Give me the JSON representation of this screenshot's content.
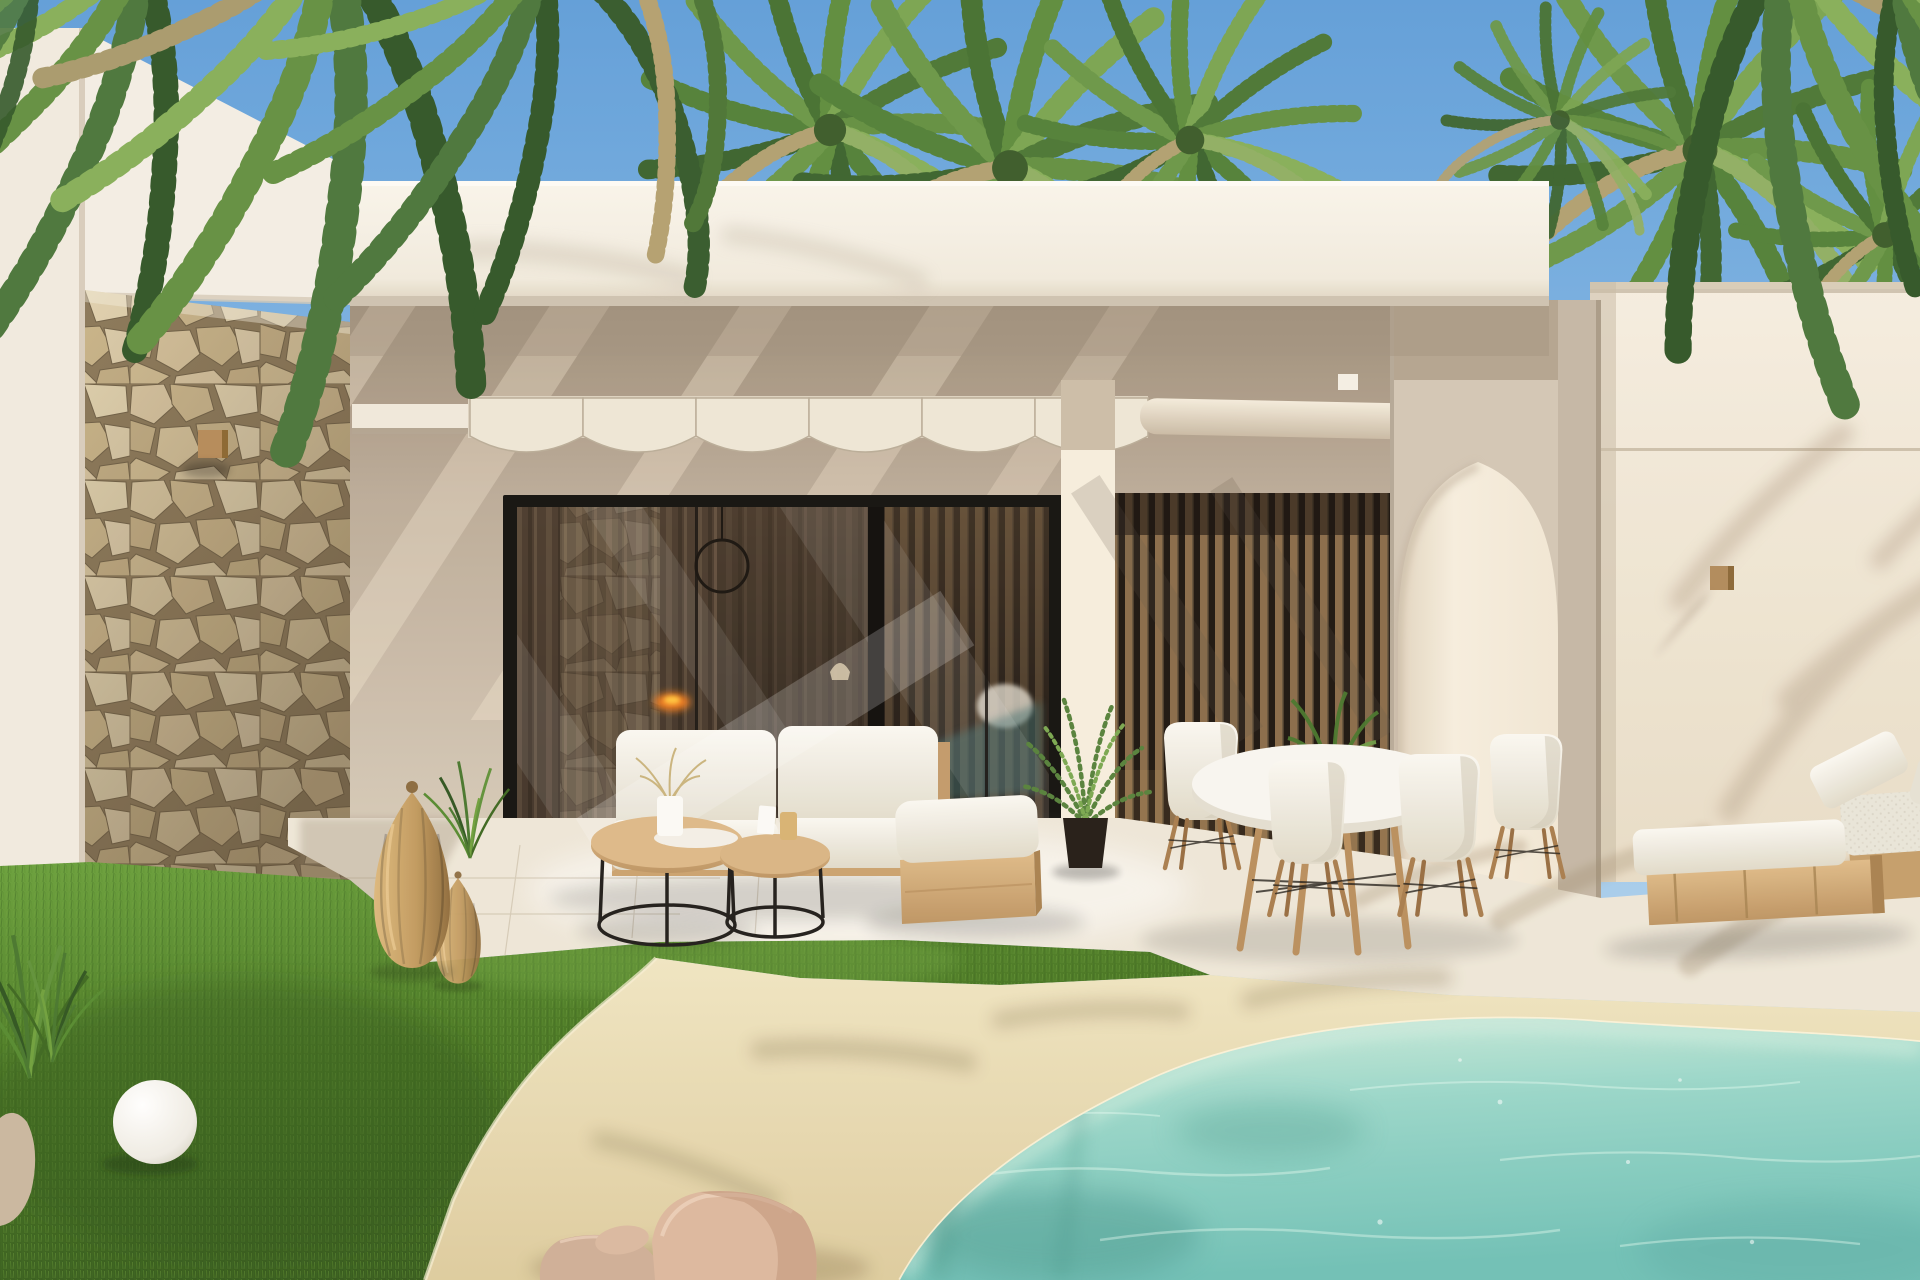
{
  "scene": {
    "title": "Modern Mediterranean villa with private pool",
    "description": "Photorealistic daytime exterior render of a cream-white modern villa: natural stone accent wall on the left, covered patio with pergola and scalloped shade canopy, black-framed sliding glass doors reflecting the interior, vertical wood slat screen, pointed arch wall opening, detached right wing wall with wooden sconce, palm trees overhead, outdoor lounge set with nesting coffee tables, round white dining set with four shell chairs, two wooden sun loungers, rattan lanterns, a white sphere lamp, green lawn, sandy free-form pool deck with pink boulders and a turquoise pool.",
    "time_of_day": "sunny daytime",
    "weather": "clear blue sky",
    "palette": {
      "sky_top": "#6fa9de",
      "sky_horizon": "#c4def1",
      "wall_cream": "#f4efe4",
      "wall_shadow": "#a2927e",
      "stone_beige": "#d5c29b",
      "stone_mortar": "#8a7758",
      "wood_warm": "#a97e52",
      "wood_light": "#d4ac76",
      "glass_dark": "#2a211a",
      "slat_brown": "#9c7a52",
      "cushion_white": "#f2efe8",
      "grass_green": "#4c7c2b",
      "sand_beige": "#e9dcb2",
      "pool_turquoise": "#8fd2c6",
      "rock_pink": "#d5b096",
      "fire_glow": "#f07b1e"
    },
    "elements": [
      {
        "name": "palm-canopy",
        "detail": "hanging fronds along top edge and crowns behind roofline",
        "count": 7
      },
      {
        "name": "stone-accent-wall",
        "detail": "irregular beige rubble masonry corner column",
        "count": 1
      },
      {
        "name": "fascia-beam",
        "detail": "white flat-roof fascia spanning the patio",
        "count": 1
      },
      {
        "name": "pergola-canopy",
        "detail": "scalloped cream shade sails and rolled awning",
        "count": 1
      },
      {
        "name": "sliding-glass-door",
        "detail": "black aluminium frame, interior with fireplace glow, ring pendant and curtains reflected",
        "count": 1
      },
      {
        "name": "wood-slat-screen",
        "detail": "floor-to-ceiling vertical wooden slats",
        "count": 1
      },
      {
        "name": "arch-opening",
        "detail": "pointed lancet arch passage in cream wall",
        "count": 1
      },
      {
        "name": "right-wing-wall",
        "detail": "cream wall with horizontal groove, palm shadows and wood sconce",
        "count": 1
      },
      {
        "name": "wall-sconce",
        "detail": "small cubic wooden light fixtures",
        "count": 2
      },
      {
        "name": "outdoor-sofa",
        "detail": "two-seat beige outdoor sofa with white cushions",
        "count": 1
      },
      {
        "name": "daybed",
        "detail": "white cushion on light plywood box base",
        "count": 1
      },
      {
        "name": "coffee-tables",
        "detail": "nesting organic-top wood tables on black wire frames",
        "count": 2
      },
      {
        "name": "dining-set",
        "detail": "round white table with four white shell chairs on wood dowel legs",
        "count": 1
      },
      {
        "name": "potted-plant",
        "detail": "areca palm in black pot plus table greenery",
        "count": 2
      },
      {
        "name": "sun-loungers",
        "detail": "wooden platform loungers with white mattresses",
        "count": 2
      },
      {
        "name": "rattan-lanterns",
        "detail": "woven teardrop floor lanterns",
        "count": 2
      },
      {
        "name": "sphere-lamp",
        "detail": "white globe garden lamp on lawn edge",
        "count": 1
      },
      {
        "name": "garden-lawn",
        "detail": "manicured green grass area",
        "count": 1
      },
      {
        "name": "pool-deck",
        "detail": "free-form sandy beige beach-entry deck",
        "count": 1
      },
      {
        "name": "pool-water",
        "detail": "turquoise pool with ripples and palm shadows",
        "count": 1
      },
      {
        "name": "rock-cluster",
        "detail": "pink-beige boulders at deck edge",
        "count": 4
      }
    ]
  }
}
